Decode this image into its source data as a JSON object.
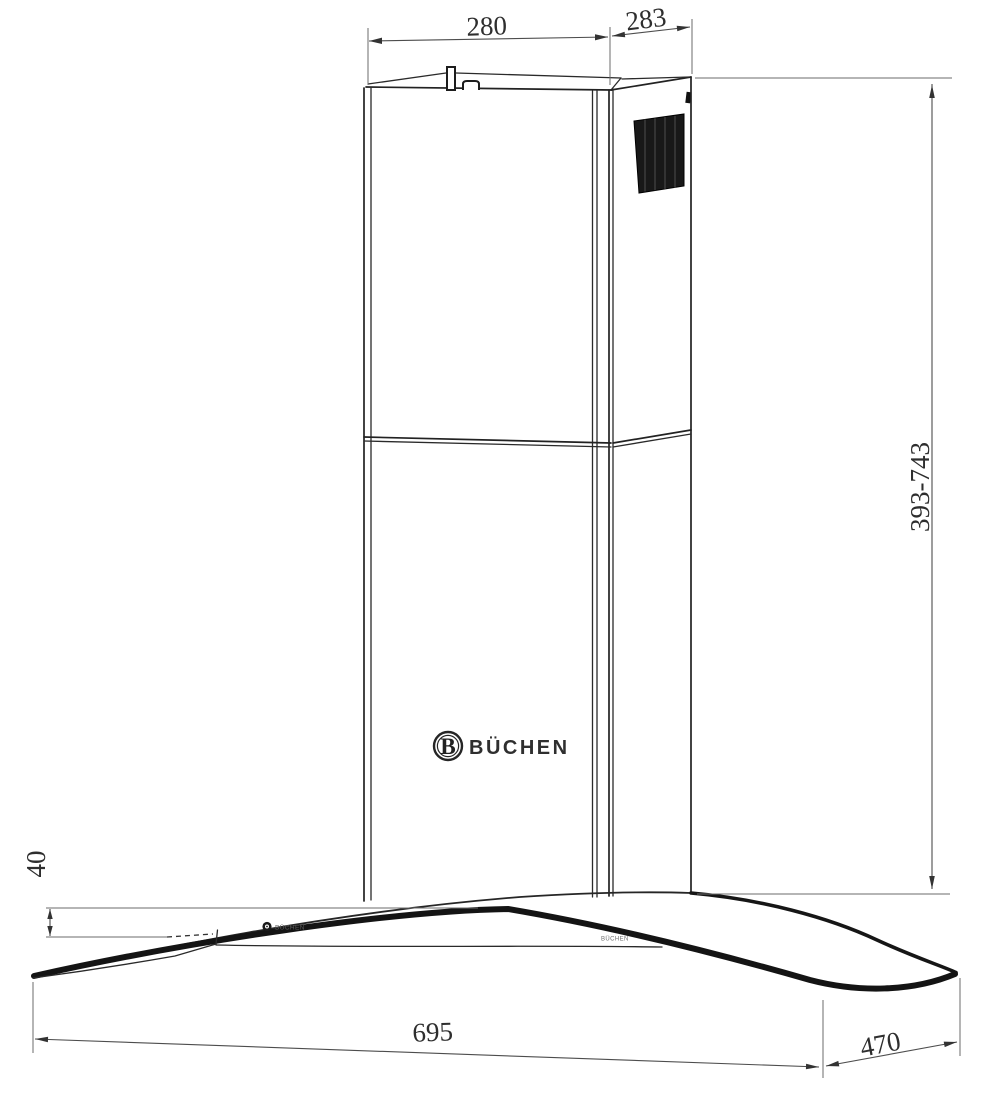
{
  "drawing": {
    "kind": "chimney-hood-technical-drawing",
    "view": "perspective-elevation"
  },
  "dimensions": {
    "top_width_mm": "280",
    "top_depth_mm": "283",
    "chimney_height_range_mm": "393-743",
    "canopy_edge_height_mm": "40",
    "canopy_width_mm": "695",
    "canopy_depth_mm": "470"
  },
  "brand": {
    "monogram": "B",
    "name": "BÜCHEN"
  },
  "canopy_labels": {
    "left_mark": "BÜCHEN",
    "right_mark": "BÜCHEN"
  },
  "colors": {
    "background": "#ffffff",
    "main_line": "#222222",
    "glass_edge": "#141414",
    "dimension_line": "#4d4d4d",
    "dimension_text": "#2e2e2e",
    "grille_fill": "#181818"
  }
}
